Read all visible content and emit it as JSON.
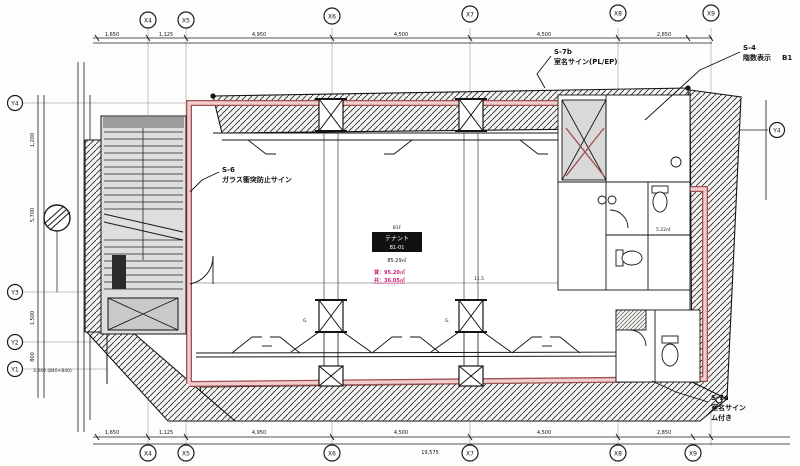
{
  "drawing": {
    "type": "architectural-floor-plan",
    "floor_area_room": "B1 tenant space"
  },
  "grid": {
    "top": [
      "X4",
      "X5",
      "X6",
      "X7",
      "X8",
      "X9"
    ],
    "bottom": [
      "X4",
      "X5",
      "X6",
      "X7",
      "X8",
      "X9"
    ],
    "left": [
      "Y4",
      "Y3",
      "Y2",
      "Y1"
    ],
    "right": [
      "Y4"
    ]
  },
  "dims": {
    "top": [
      "1,650",
      "1,125",
      "4,950",
      "4,500",
      "4,500",
      "2,850"
    ],
    "bottom": [
      "1,650",
      "1,125",
      "4,950",
      "4,500",
      "4,500",
      "2,850"
    ],
    "bottom_total": "19,575",
    "left": [
      "1,200",
      "5,700",
      "1,500",
      "800"
    ],
    "inline_mid": "11.5",
    "corner_note": "3,040 (840+840)"
  },
  "labels": {
    "s6": {
      "code": "S-6",
      "text": "ガラス衝突防止サイン"
    },
    "s7b": {
      "code": "S-7b",
      "text": "室名サイン(PL/EP)"
    },
    "s4": {
      "code": "S-4",
      "text": "階数表示",
      "floor": "B1"
    },
    "s7a": {
      "code": "S-7a",
      "line1": "室名サイン",
      "line2": "ム付き"
    }
  },
  "room_tag": {
    "header": "B1F",
    "line1": "テナント",
    "line2": "B1-01",
    "area": "85.29㎡",
    "rent": "貸：95.20㎡",
    "common": "共：36.05㎡"
  },
  "small_areas": {
    "wc": "5.22㎡"
  },
  "misc": {
    "col_label": "G"
  },
  "colors": {
    "line": "#1b1b1b",
    "tenant_outline_dark": "#a05252",
    "tenant_outline_pink": "#f2cdcd",
    "magenta_text": "#cc2277",
    "hatch_bg": "#f5f5f3",
    "stair_gray": "#dedede"
  }
}
